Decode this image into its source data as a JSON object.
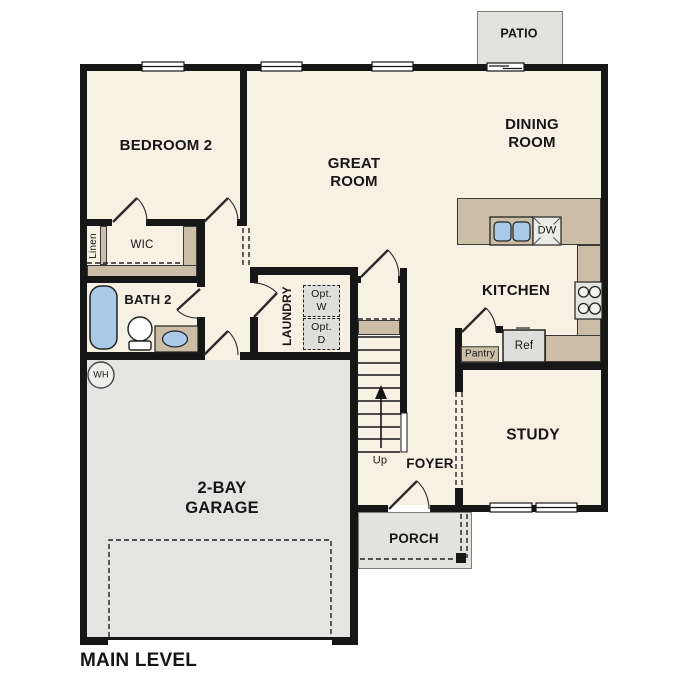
{
  "plan_title": "MAIN LEVEL",
  "rooms": {
    "patio": "PATIO",
    "dining_room": "DINING\nROOM",
    "great_room": "GREAT\nROOM",
    "bedroom_2": "BEDROOM 2",
    "kitchen": "KITCHEN",
    "bath_2": "BATH 2",
    "wic": "WIC",
    "linen": "Linen",
    "laundry": "LAUNDRY",
    "study": "STUDY",
    "foyer": "FOYER",
    "porch": "PORCH",
    "garage": "2-BAY\nGARAGE"
  },
  "annotations": {
    "opt_washer": "Opt.\nW",
    "opt_dryer": "Opt.\nD",
    "dishwasher": "DW",
    "refrigerator": "Ref",
    "pantry": "Pantry",
    "water_heater": "WH",
    "stairs_direction": "Up"
  },
  "colors": {
    "floor": "#f7f1e3",
    "wall": "#161616",
    "garage_floor": "#e4e4e2",
    "outdoor_floor": "#e2e2df",
    "counter": "#cbbda6",
    "fixture_blue": "#a9c9e9",
    "appliance": "#dededc"
  }
}
